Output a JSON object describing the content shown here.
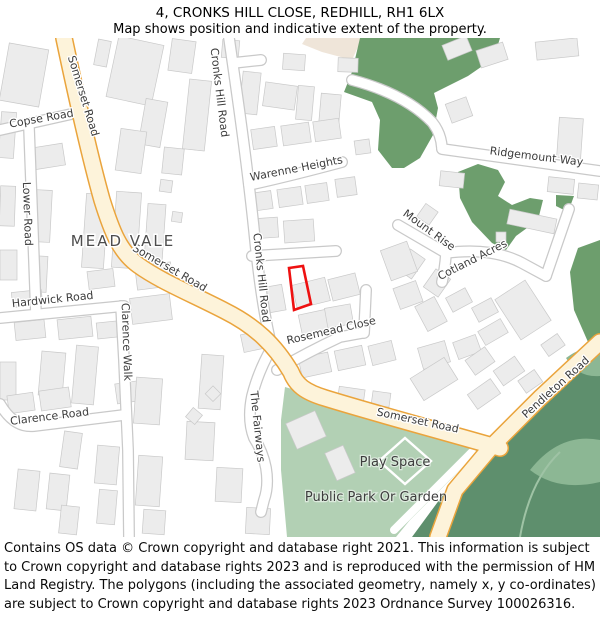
{
  "header": {
    "title": "4, CRONKS HILL CLOSE, REDHILL, RH1 6LX",
    "subtitle": "Map shows position and indicative extent of the property."
  },
  "map": {
    "area_label": "MEAD VALE",
    "road_labels": [
      {
        "id": "somerset-road-top",
        "label": "Somerset Road"
      },
      {
        "id": "somerset-road-mid",
        "label": "Somerset Road"
      },
      {
        "id": "somerset-road-bottom",
        "label": "Somerset Road"
      },
      {
        "id": "pendleton-road",
        "label": "Pendleton Road"
      },
      {
        "id": "copse-road",
        "label": "Copse Road"
      },
      {
        "id": "lower-road",
        "label": "Lower Road"
      },
      {
        "id": "hardwick-road",
        "label": "Hardwick Road"
      },
      {
        "id": "clarence-road",
        "label": "Clarence Road"
      },
      {
        "id": "clarence-walk",
        "label": "Clarence Walk"
      },
      {
        "id": "cronks-hill-road-top",
        "label": "Cronks Hill Road"
      },
      {
        "id": "cronks-hill-road-mid",
        "label": "Cronks Hill Road"
      },
      {
        "id": "warenne-heights",
        "label": "Warenne Heights"
      },
      {
        "id": "ridgemount-way",
        "label": "Ridgemount Way"
      },
      {
        "id": "mount-rise",
        "label": "Mount Rise"
      },
      {
        "id": "cotland-acres",
        "label": "Cotland Acres"
      },
      {
        "id": "rosemead-close",
        "label": "Rosemead Close"
      },
      {
        "id": "the-fairways",
        "label": "The Fairways"
      }
    ],
    "poi_labels": {
      "play_space": "Play Space",
      "public_park": "Public Park Or Garden"
    },
    "colors": {
      "main_road_fill": "#fdf3da",
      "main_road_edge": "#eaa43c",
      "minor_road_fill": "#ffffff",
      "minor_road_edge": "#c9c9c9",
      "building_fill": "#ececec",
      "building_edge": "#c9c9c9",
      "woodland_green": "#6d9e6d",
      "park_green": "#b2d0b4",
      "dense_green": "#5e8f6d",
      "land_beige": "#efe5d9",
      "property_outline": "#ee1111"
    }
  },
  "footer": {
    "text": "Contains OS data © Crown copyright and database right 2021. This information is subject to Crown copyright and database rights 2023 and is reproduced with the permission of HM Land Registry. The polygons (including the associated geometry, namely x, y co-ordinates) are subject to Crown copyright and database rights 2023 Ordnance Survey 100026316."
  }
}
